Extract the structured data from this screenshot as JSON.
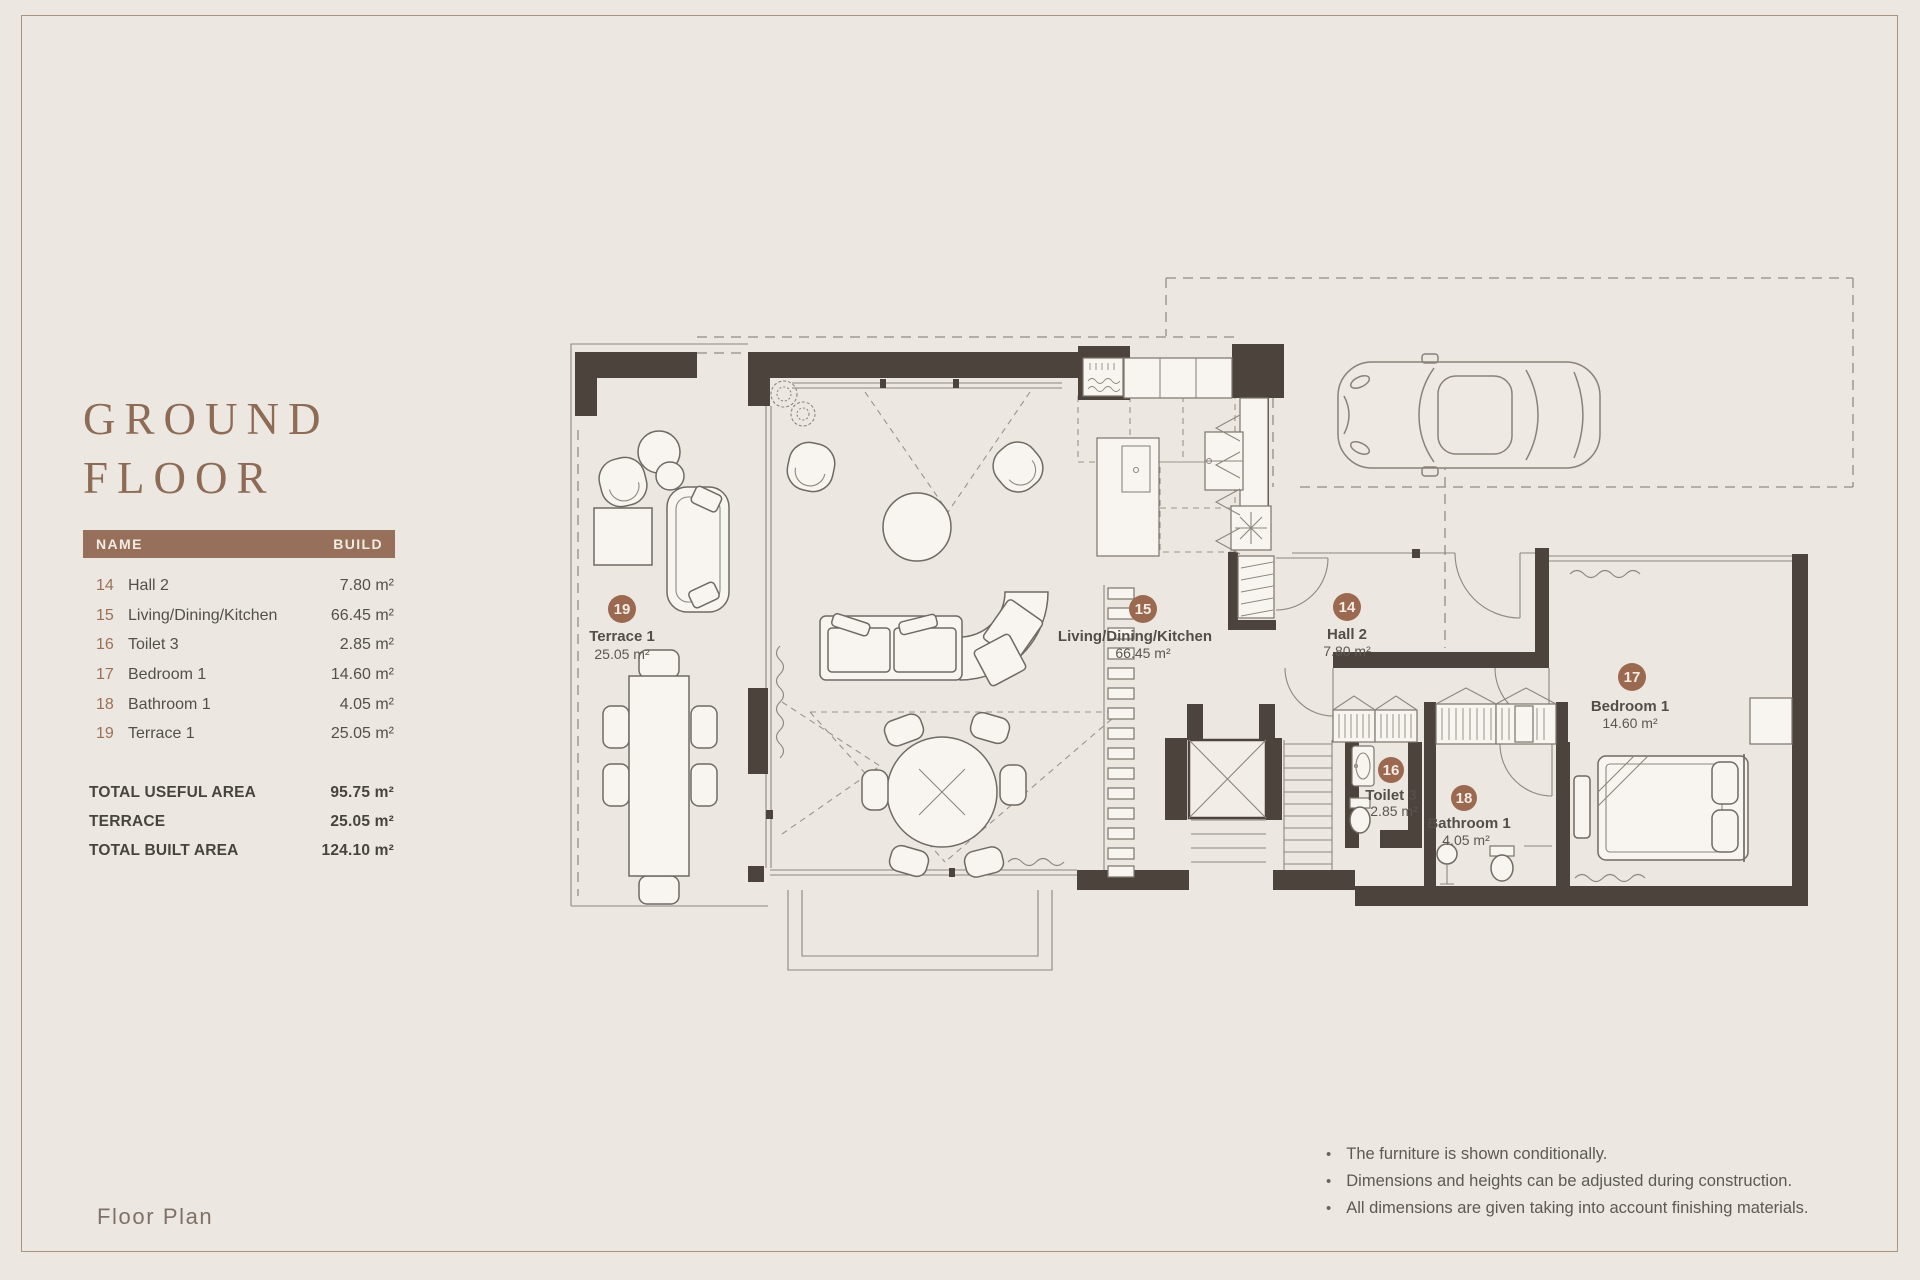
{
  "header": {
    "title_line1": "GROUND",
    "title_line2": "FLOOR"
  },
  "area_table": {
    "col_name": "NAME",
    "col_build": "BUILD",
    "rows": [
      {
        "num": "14",
        "name": "Hall 2",
        "area": "7.80 m²"
      },
      {
        "num": "15",
        "name": "Living/Dining/Kitchen",
        "area": "66.45 m²"
      },
      {
        "num": "16",
        "name": "Toilet 3",
        "area": "2.85 m²"
      },
      {
        "num": "17",
        "name": "Bedroom 1",
        "area": "14.60 m²"
      },
      {
        "num": "18",
        "name": "Bathroom 1",
        "area": "4.05 m²"
      },
      {
        "num": "19",
        "name": "Terrace 1",
        "area": "25.05 m²"
      }
    ],
    "totals": [
      {
        "label": "TOTAL USEFUL AREA",
        "value": "95.75 m²"
      },
      {
        "label": "TERRACE",
        "value": "25.05 m²"
      },
      {
        "label": "TOTAL BUILT AREA",
        "value": "124.10 m²"
      }
    ]
  },
  "plan": {
    "rooms": [
      {
        "num": "19",
        "name": "Terrace 1",
        "area": "25.05 m²"
      },
      {
        "num": "15",
        "name": "Living/Dining/Kitchen",
        "area": "66.45 m²"
      },
      {
        "num": "14",
        "name": "Hall 2",
        "area": "7.80 m²"
      },
      {
        "num": "16",
        "name": "Toilet 3",
        "area": "2.85 m²"
      },
      {
        "num": "18",
        "name": "Bathroom 1",
        "area": "4.05 m²"
      },
      {
        "num": "17",
        "name": "Bedroom 1",
        "area": "14.60 m²"
      }
    ]
  },
  "notes": {
    "bullet": "•",
    "items": [
      "The furniture is shown conditionally.",
      "Dimensions and heights can be adjusted during construction.",
      "All dimensions are given taking into account finishing materials."
    ]
  },
  "footer": {
    "label": "Floor Plan"
  },
  "colors": {
    "accent": "#96705a",
    "wall": "#4c443c",
    "background": "#ece7e1",
    "label_circle": "#9a6950"
  }
}
